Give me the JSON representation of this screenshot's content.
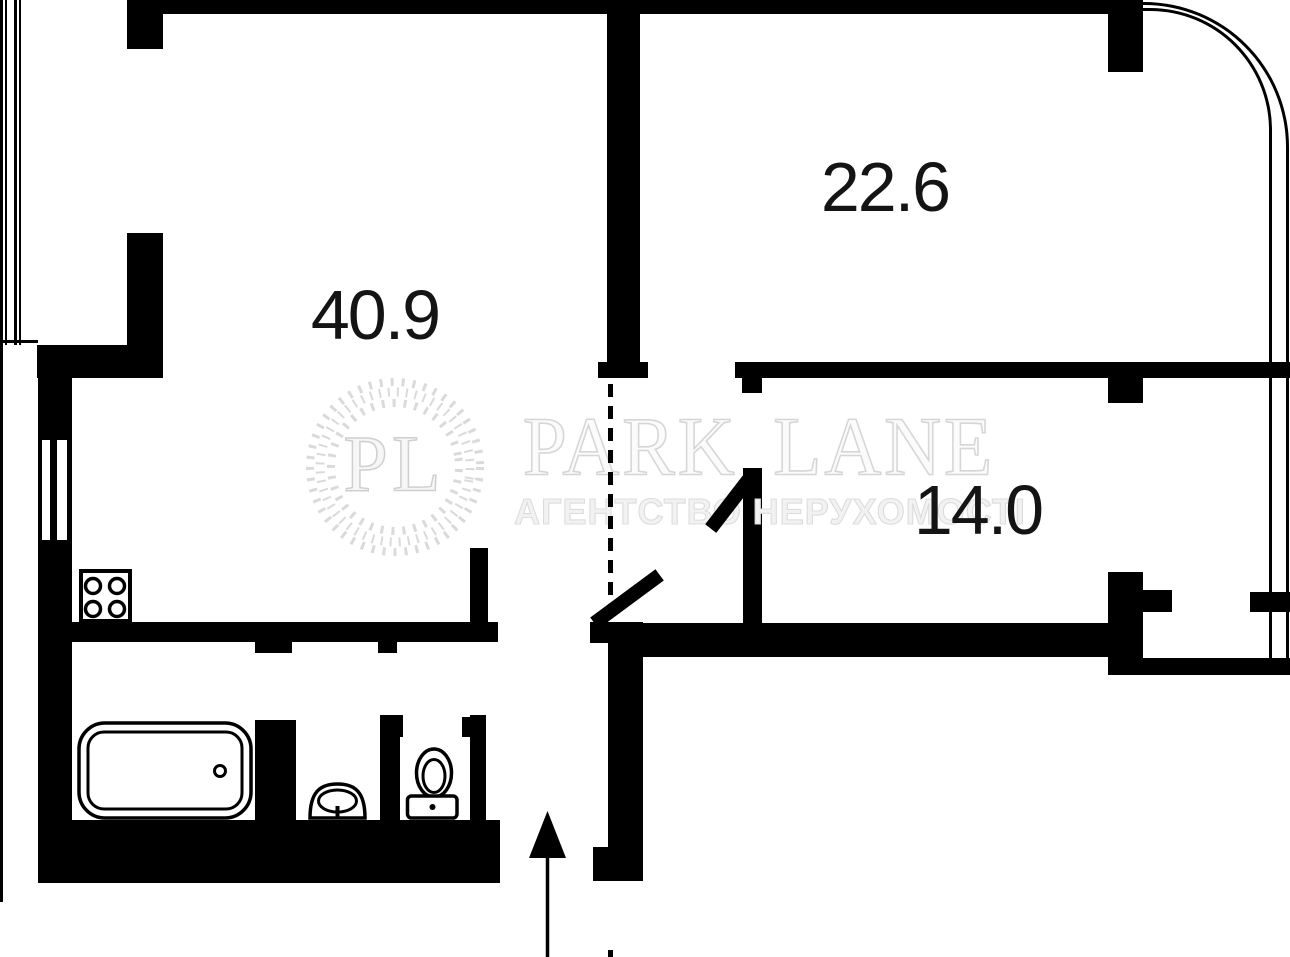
{
  "plan": {
    "rooms": [
      {
        "name": "living-room",
        "area": "40.9"
      },
      {
        "name": "bedroom",
        "area": "22.6"
      },
      {
        "name": "second-room",
        "area": "14.0"
      }
    ],
    "fixtures": [
      "stove",
      "bathtub",
      "sink",
      "toilet",
      "entrance-arrow",
      "door-leaf",
      "window",
      "balcony-glazing"
    ]
  },
  "watermark": {
    "monogram": "PL",
    "brand": "PARK LANE",
    "tagline": "АГЕНТСТВО НЕРУХОМОСТІ"
  },
  "colors": {
    "wall": "#000000",
    "background": "#ffffff",
    "watermark": "#d9d9d9",
    "label": "#141414"
  }
}
